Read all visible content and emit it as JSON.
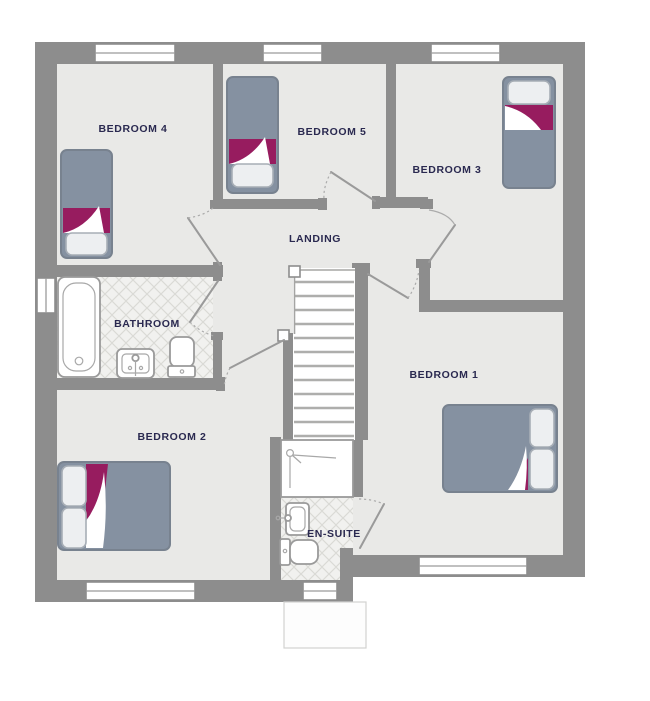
{
  "plan": {
    "type": "floor-plan",
    "rooms": {
      "bedroom4": {
        "label": "BEDROOM 4"
      },
      "bedroom5": {
        "label": "BEDROOM 5"
      },
      "bedroom3": {
        "label": "BEDROOM 3"
      },
      "landing": {
        "label": "LANDING"
      },
      "bathroom": {
        "label": "BATHROOM"
      },
      "bedroom2": {
        "label": "BEDROOM 2"
      },
      "ensuite": {
        "label": "EN-SUITE"
      },
      "bedroom1": {
        "label": "BEDROOM 1"
      }
    },
    "colors": {
      "wall": "#8d8d8d",
      "floor": "#e9e9e7",
      "tile_background": "#f1f1ef",
      "tile_line": "#dadad6",
      "bed": "#8591a1",
      "bed_border": "#78828f",
      "pillow": "#edeff1",
      "accent_maroon": "#971c5f",
      "label_text": "#2a2950",
      "fixture_line": "#9a9a9a"
    }
  }
}
